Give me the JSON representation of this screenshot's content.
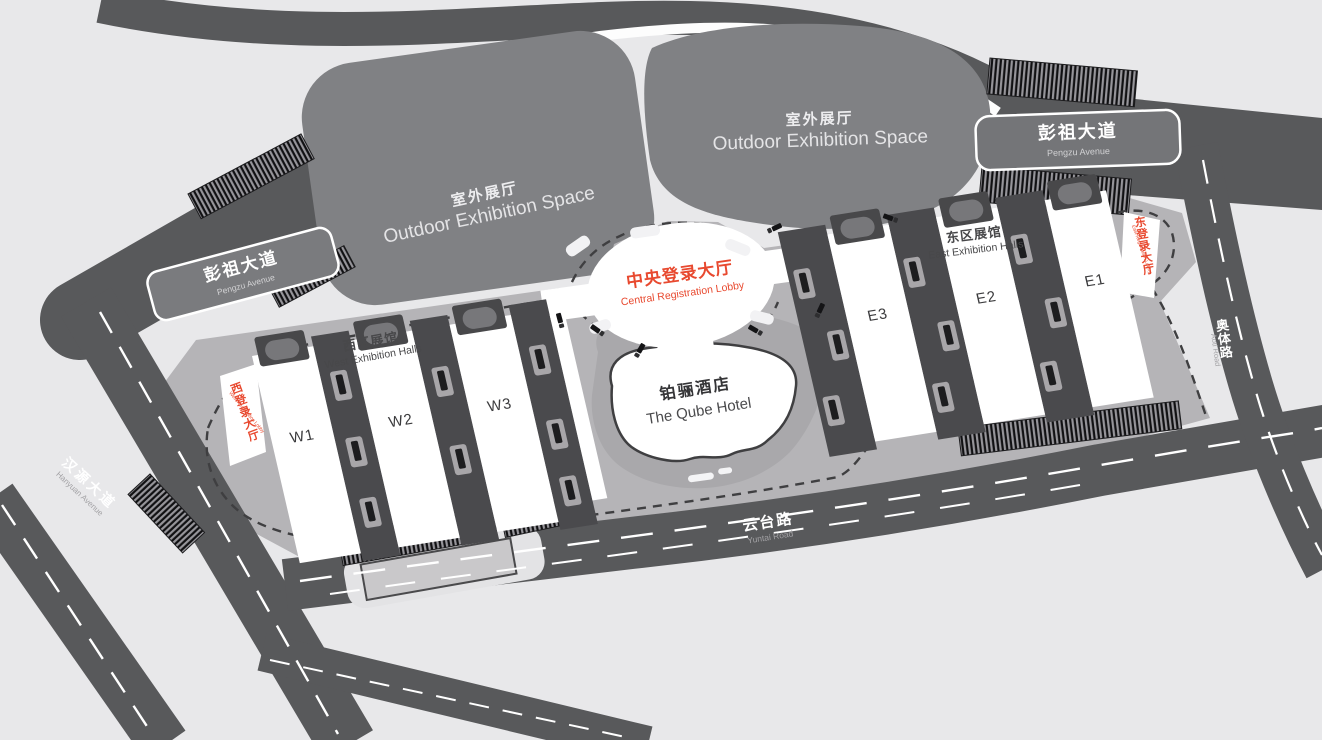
{
  "colors": {
    "background": "#e8e8ea",
    "road": "#58595b",
    "outdoor_space": "#808184",
    "campus": "#b5b4b7",
    "hall_corridor": "#4a4a4d",
    "hall_fill": "#ffffff",
    "accent_red": "#e8492f",
    "dark_text": "#414042",
    "white_text": "#ffffff"
  },
  "map": {
    "outdoor_spaces": [
      {
        "id": "west",
        "cn": "室外展厅",
        "en": "Outdoor Exhibition Space"
      },
      {
        "id": "east",
        "cn": "室外展厅",
        "en": "Outdoor Exhibition Space"
      }
    ],
    "roads": {
      "pengzu_left": {
        "cn": "彭祖大道",
        "en": "Pengzu Avenue"
      },
      "pengzu_right": {
        "cn": "彭祖大道",
        "en": "Pengzu Avenue"
      },
      "hanyuan": {
        "cn": "汉源大道",
        "en": "Hanyuan Avenue"
      },
      "yuntai": {
        "cn": "云台路",
        "en": "Yuntai Road"
      },
      "aoti": {
        "cn": "奥体路",
        "en": "Aoti Road"
      }
    },
    "lobbies": {
      "central": {
        "cn": "中央登录大厅",
        "en": "Central Registration Lobby"
      },
      "west": {
        "cn": "西登录大厅",
        "en": "West Registration Lobby"
      },
      "east": {
        "cn": "东登录大厅",
        "en": "East Registration Lobby"
      }
    },
    "hall_groups": {
      "west": {
        "cn": "西区展馆",
        "en": "West Exhibition Halls",
        "halls": [
          "W1",
          "W2",
          "W3"
        ]
      },
      "east": {
        "cn": "东区展馆",
        "en": "East Exhibition Halls",
        "halls": [
          "E3",
          "E2",
          "E1"
        ]
      }
    },
    "hotel": {
      "cn": "铂骊酒店",
      "en": "The Qube Hotel"
    }
  }
}
